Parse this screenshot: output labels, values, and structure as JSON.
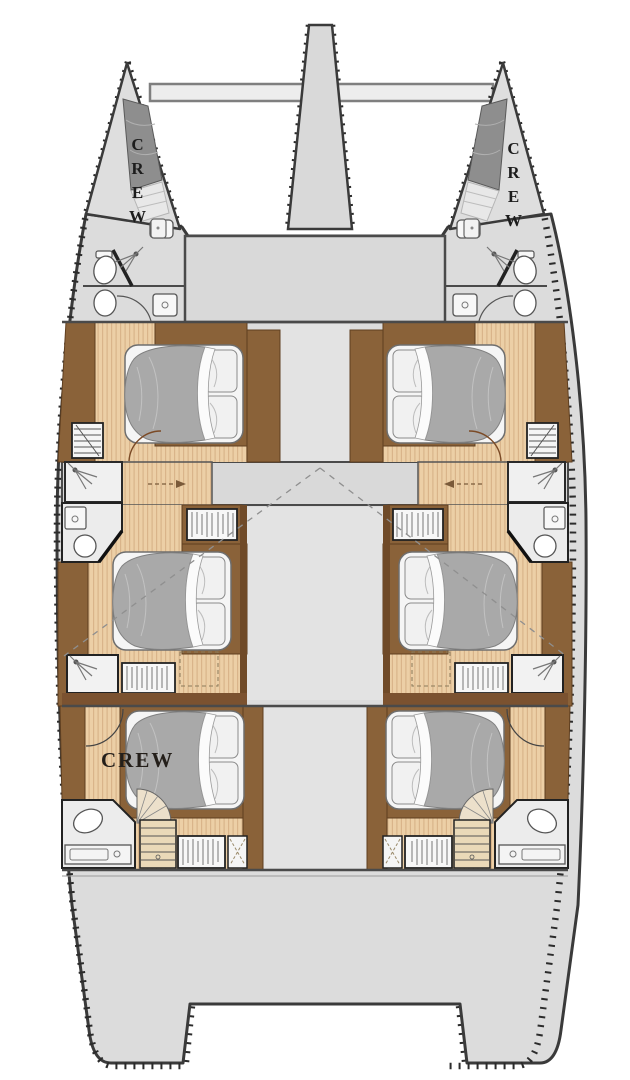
{
  "plan": {
    "labels": {
      "port_bow_crew": "CREW",
      "starboard_bow_crew": "CREW",
      "port_aft_crew": "CREW"
    },
    "colors": {
      "background": "#ffffff",
      "deck_gray": "#dcdcdc",
      "deck_light": "#e3e3e3",
      "outline_dark": "#3a3a3a",
      "wood_floor": "#eccfa6",
      "wood_stripe": "#d9b48a",
      "wood_trim_brown": "#8a6239",
      "wood_trim_dark": "#6f4a28",
      "bed_duvet_gray": "#a9a9a9",
      "crew_berth_gray": "#8e8e8e",
      "fixture_white": "#f2f2f2"
    }
  }
}
